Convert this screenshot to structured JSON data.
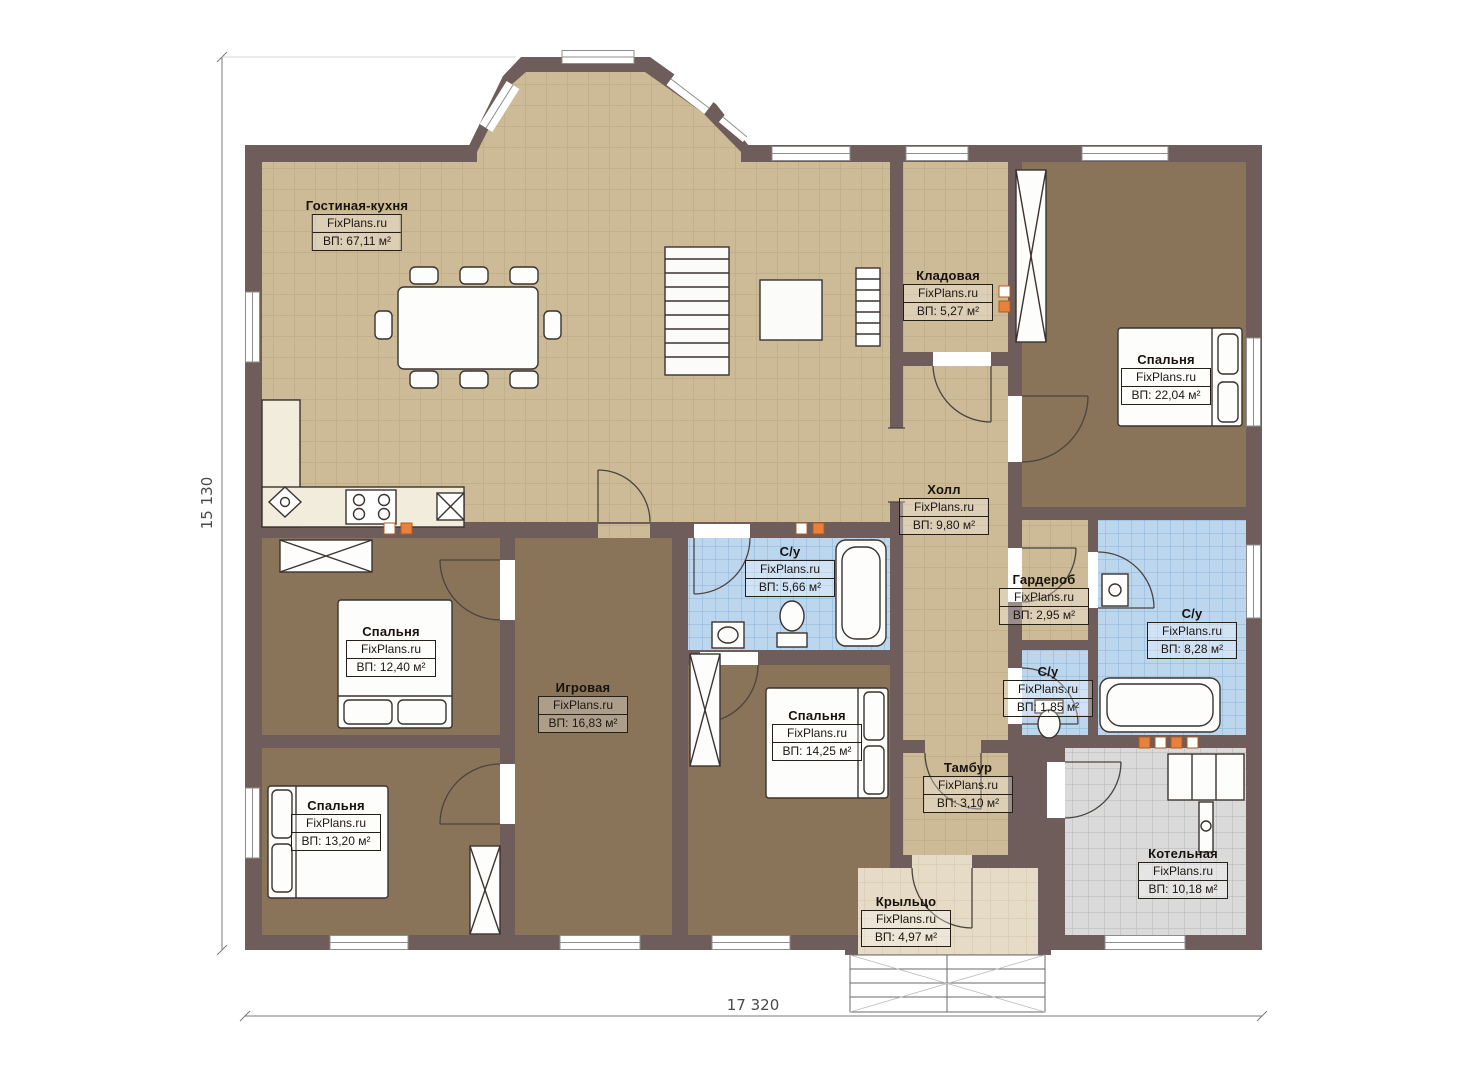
{
  "brand": "FixPlans.ru",
  "dimensions": {
    "height_label": "15 130",
    "width_label": "17 320"
  },
  "rooms": {
    "living": {
      "name": "Гостиная-кухня",
      "area": "ВП: 67,11 м²"
    },
    "kladovaya": {
      "name": "Кладовая",
      "area": "ВП: 5,27 м²"
    },
    "bedroom_tr": {
      "name": "Спальня",
      "area": "ВП: 22,04 м²"
    },
    "hall": {
      "name": "Холл",
      "area": "ВП: 9,80 м²"
    },
    "su_top": {
      "name": "С/у",
      "area": "ВП: 5,66 м²"
    },
    "garderob": {
      "name": "Гардероб",
      "area": "ВП: 2,95 м²"
    },
    "su_right": {
      "name": "С/у",
      "area": "ВП: 8,28 м²"
    },
    "su_small": {
      "name": "С/у",
      "area": "ВП: 1,85 м²"
    },
    "bedroom_left": {
      "name": "Спальня",
      "area": "ВП: 12,40 м²"
    },
    "igrovaya": {
      "name": "Игровая",
      "area": "ВП: 16,83 м²"
    },
    "bedroom_mid": {
      "name": "Спальня",
      "area": "ВП: 14,25 м²"
    },
    "bedroom_bl": {
      "name": "Спальня",
      "area": "ВП: 13,20 м²"
    },
    "tambur": {
      "name": "Тамбур",
      "area": "ВП: 3,10 м²"
    },
    "kotelnaya": {
      "name": "Котельная",
      "area": "ВП: 10,18 м²"
    },
    "kryltso": {
      "name": "Крыльцо",
      "area": "ВП: 4,97 м²"
    }
  },
  "colors": {
    "wall": "#6f5d5b",
    "tile_tan": "#cdbb97",
    "tile_blue": "#bcd6ee",
    "tile_gray": "#dadada",
    "floor_brown": "#8a7459",
    "porch": "#e6dbc7",
    "accent_orange": "#e8813c"
  }
}
